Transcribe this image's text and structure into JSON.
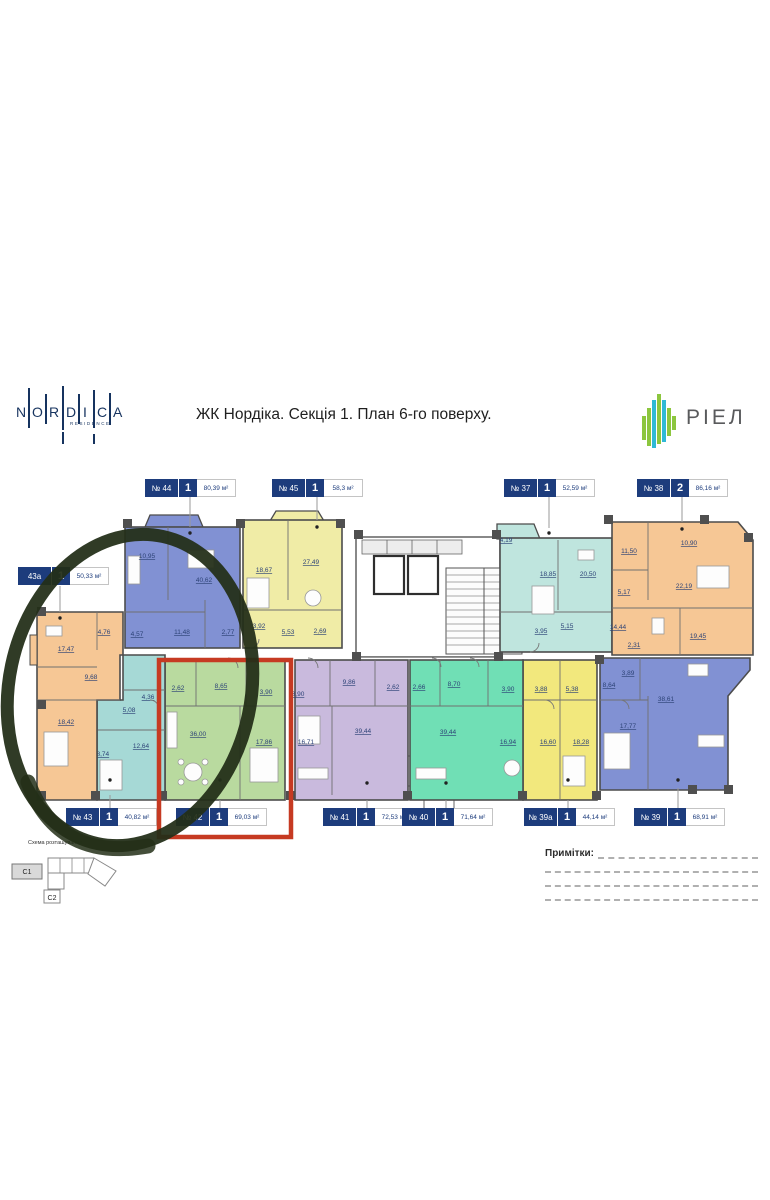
{
  "header": {
    "title": "ЖК Нордіка. Секція 1. План 6-го поверху.",
    "nordica": {
      "letters": [
        "N",
        "O",
        "R",
        "D",
        "I",
        "C",
        "A"
      ],
      "residence": "RESIDENCE"
    },
    "riel": "РІЕЛ"
  },
  "units": [
    {
      "num": "№ 44",
      "rooms": "1",
      "area": "80,39 м²"
    },
    {
      "num": "№ 45",
      "rooms": "1",
      "area": "58,3 м²"
    },
    {
      "num": "№ 37",
      "rooms": "1",
      "area": "52,59 м²"
    },
    {
      "num": "№ 38",
      "rooms": "2",
      "area": "86,16 м²"
    },
    {
      "num": "43а",
      "rooms": "1",
      "area": "50,33 м²"
    },
    {
      "num": "№ 43",
      "rooms": "1",
      "area": "40,82 м²"
    },
    {
      "num": "№ 42",
      "rooms": "1",
      "area": "69,03 м²"
    },
    {
      "num": "№ 41",
      "rooms": "1",
      "area": "72,53 м²"
    },
    {
      "num": "№ 40",
      "rooms": "1",
      "area": "71,64 м²"
    },
    {
      "num": "№ 39а",
      "rooms": "1",
      "area": "44,14 м²"
    },
    {
      "num": "№ 39",
      "rooms": "1",
      "area": "68,91 м²"
    }
  ],
  "plan": {
    "apt44": {
      "rooms": [
        "10,95",
        "40,62",
        "11,48",
        "4,57",
        "2,77"
      ]
    },
    "apt45": {
      "rooms": [
        "18,67",
        "27,49",
        "3,92",
        "5,53",
        "2,69"
      ]
    },
    "apt37": {
      "rooms": [
        "4,19",
        "18,85",
        "20,50",
        "3,95",
        "5,15"
      ]
    },
    "apt38": {
      "rooms": [
        "11,50",
        "10,90",
        "22,19",
        "5,17",
        "14,44",
        "2,31",
        "19,45"
      ]
    },
    "apt39": {
      "rooms": [
        "3,89",
        "8,64",
        "38,61",
        "17,77"
      ]
    },
    "apt39a": {
      "rooms": [
        "3,88",
        "5,38",
        "16,60",
        "18,28"
      ]
    },
    "apt40": {
      "rooms": [
        "2,66",
        "8,70",
        "3,90",
        "39,44",
        "16,94"
      ]
    },
    "apt41": {
      "rooms": [
        "3,90",
        "9,86",
        "2,62",
        "39,44",
        "16,71"
      ]
    },
    "apt42": {
      "rooms": [
        "2,62",
        "8,65",
        "3,90",
        "36,00",
        "17,86"
      ]
    },
    "apt43": {
      "rooms": [
        "4,36",
        "5,08",
        "12,64",
        "18,74"
      ]
    },
    "apt43a": {
      "rooms": [
        "4,76",
        "17,47",
        "9,68",
        "18,42"
      ]
    }
  },
  "footer": {
    "scheme_label": "Схема розташування",
    "c1": "С1",
    "c2": "С2",
    "notes_label": "Примітки:"
  },
  "colors": {
    "label_navy": "#1d3c7c",
    "apt_blue": "#8191d3",
    "apt_yellow": "#f0eca6",
    "apt_yellow_bright": "#f2e87d",
    "apt_teal_light": "#bfe5de",
    "apt_mint": "#70dfb5",
    "apt_orange": "#f6c795",
    "apt_purple": "#c9badd",
    "apt_green": "#b9da9f",
    "apt_cyan": "#a6d9d6",
    "riel_green": "#8cc63e",
    "riel_cyan": "#2fb9d6",
    "highlight_red": "#c63a22",
    "annotation_green": "#232f18"
  }
}
